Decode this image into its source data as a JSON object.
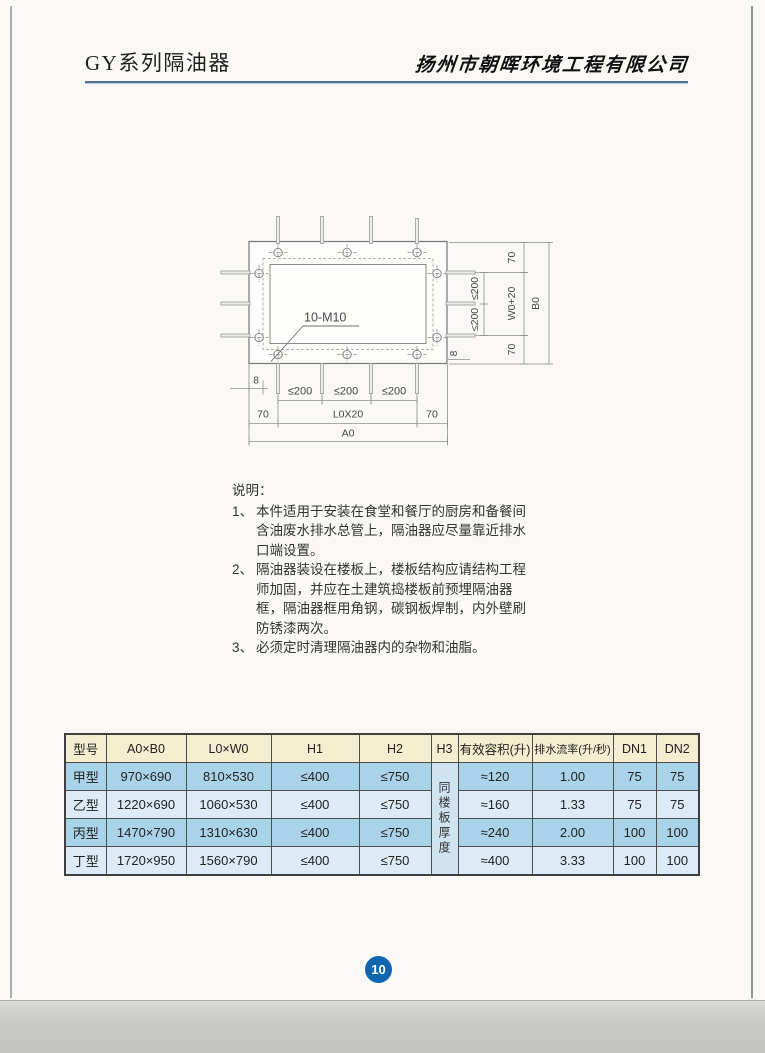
{
  "header": {
    "title": "GY系列隔油器",
    "company": "扬州市朝晖环境工程有限公司"
  },
  "diagram": {
    "bolt_label": "10-M10",
    "right_dims": {
      "top_70": "70",
      "seg_200_a": "≤200",
      "seg_200_b": "≤200",
      "w0_plus_20": "W0+20",
      "b0": "B0",
      "gap_8": "8",
      "bottom_70": "70"
    },
    "bottom_dims": {
      "gap_8": "8",
      "seg_200_a": "≤200",
      "seg_200_b": "≤200",
      "seg_200_c": "≤200",
      "left_70": "70",
      "l0x20": "L0X20",
      "right_70": "70",
      "a0": "A0"
    }
  },
  "notes": {
    "title": "说明：",
    "items": [
      {
        "num": "1、",
        "text": "本件适用于安装在食堂和餐厅的厨房和备餐间含油废水排水总管上，隔油器应尽量靠近排水口端设置。"
      },
      {
        "num": "2、",
        "text": "隔油器装设在楼板上，楼板结构应请结构工程师加固，并应在土建筑捣楼板前预埋隔油器框，隔油器框用角钢，碳钢板焊制，内外壁刷防锈漆两次。"
      },
      {
        "num": "3、",
        "text": "必须定时清理隔油器内的杂物和油脂。"
      }
    ]
  },
  "table": {
    "headers": [
      "型号",
      "A0×B0",
      "L0×W0",
      "H1",
      "H2",
      "H3",
      "有效容积(升)",
      "排水流率(升/秒)",
      "DN1",
      "DN2"
    ],
    "h3_note": "同楼板厚度",
    "rows": [
      {
        "model": "甲型",
        "a0b0": "970×690",
        "l0w0": "810×530",
        "h1": "≤400",
        "h2": "≤750",
        "volume": "≈120",
        "flow": "1.00",
        "dn1": "75",
        "dn2": "75"
      },
      {
        "model": "乙型",
        "a0b0": "1220×690",
        "l0w0": "1060×530",
        "h1": "≤400",
        "h2": "≤750",
        "volume": "≈160",
        "flow": "1.33",
        "dn1": "75",
        "dn2": "75"
      },
      {
        "model": "丙型",
        "a0b0": "1470×790",
        "l0w0": "1310×630",
        "h1": "≤400",
        "h2": "≤750",
        "volume": "≈240",
        "flow": "2.00",
        "dn1": "100",
        "dn2": "100"
      },
      {
        "model": "丁型",
        "a0b0": "1720×950",
        "l0w0": "1560×790",
        "h1": "≤400",
        "h2": "≤750",
        "volume": "≈400",
        "flow": "3.33",
        "dn1": "100",
        "dn2": "100"
      }
    ]
  },
  "footer": {
    "page_number": "10"
  },
  "colors": {
    "header_underline": "#4f7391",
    "table_header_bg": "#f3eecf",
    "row_blue_bg": "#a9d3e9",
    "row_light_bg": "#dcebf5",
    "h3_cell_bg": "#cfe3f0",
    "page_circle_bg": "#1066ae"
  }
}
